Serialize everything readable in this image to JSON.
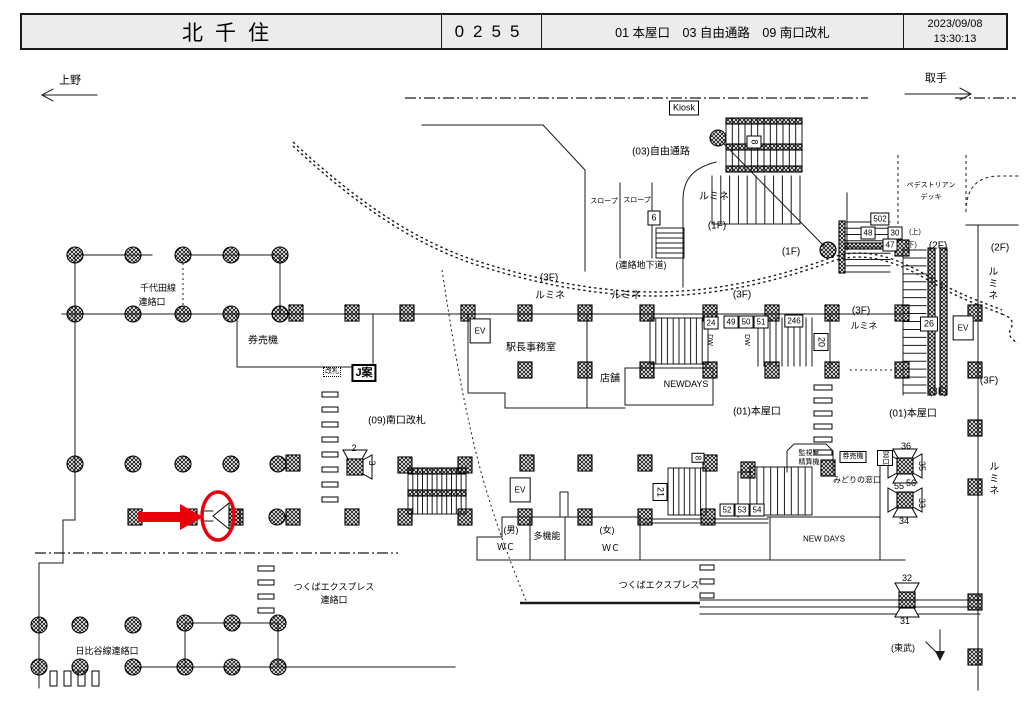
{
  "header": {
    "station": "北千住",
    "code": "0255",
    "sections": "01 本屋口　03 自由通路　09 南口改札",
    "date": "2023/09/08",
    "time": "13:30:13"
  },
  "directions": {
    "left": "上野",
    "right": "取手"
  },
  "colors": {
    "highlight": "#e8000b",
    "ink": "#1a1a1a",
    "header_bg": "#ececec"
  },
  "map_labels": [
    {
      "t": "上野",
      "x": 70,
      "y": 81,
      "c": "f11",
      "n": "direction-ueno"
    },
    {
      "t": "取手",
      "x": 936,
      "y": 79,
      "c": "f11",
      "n": "direction-toride"
    },
    {
      "t": "Kiosk",
      "x": 684,
      "y": 108,
      "c": "bx",
      "n": "kiosk-label"
    },
    {
      "t": "(03)自由通路",
      "x": 661,
      "y": 152,
      "c": "",
      "n": "area-03-jiyutsuro"
    },
    {
      "t": "スロープ",
      "x": 604,
      "y": 202,
      "c": "t",
      "n": "slope-label"
    },
    {
      "t": "スロープ",
      "x": 637,
      "y": 201,
      "c": "t",
      "n": "slope-label"
    },
    {
      "t": "6",
      "x": 654,
      "y": 218,
      "c": "bx",
      "n": "sign-6"
    },
    {
      "t": "ルミネ",
      "x": 714,
      "y": 197,
      "c": "",
      "n": "lumine-label"
    },
    {
      "t": "(1F)",
      "x": 717,
      "y": 226,
      "c": "",
      "n": "floor-1f"
    },
    {
      "t": "(連絡地下道)",
      "x": 641,
      "y": 265,
      "c": "s",
      "n": "underpass-label"
    },
    {
      "t": "8",
      "x": 754,
      "y": 142,
      "c": "bx rot",
      "n": "sign-8"
    },
    {
      "t": "ペデストリアン",
      "x": 931,
      "y": 186,
      "c": "t",
      "n": "pedestrian-deck-label"
    },
    {
      "t": "デッキ",
      "x": 931,
      "y": 198,
      "c": "t",
      "n": "pedestrian-deck-label"
    },
    {
      "t": "(1F)",
      "x": 791,
      "y": 252,
      "c": "",
      "n": "floor-1f"
    },
    {
      "t": "(2F)",
      "x": 938,
      "y": 246,
      "c": "",
      "n": "floor-2f"
    },
    {
      "t": "(2F)",
      "x": 1000,
      "y": 248,
      "c": "",
      "n": "floor-2f"
    },
    {
      "t": "502",
      "x": 880,
      "y": 219,
      "c": "bxs",
      "n": "sign-502"
    },
    {
      "t": "48",
      "x": 868,
      "y": 233,
      "c": "bxs",
      "n": "sign-48"
    },
    {
      "t": "30",
      "x": 895,
      "y": 233,
      "c": "bxs",
      "n": "sign-30"
    },
    {
      "t": "(上)",
      "x": 915,
      "y": 233,
      "c": "t",
      "n": "up-label"
    },
    {
      "t": "47",
      "x": 890,
      "y": 245,
      "c": "bxs",
      "n": "sign-47"
    },
    {
      "t": "(下)",
      "x": 911,
      "y": 246,
      "c": "t",
      "n": "down-label"
    },
    {
      "t": "(3F)",
      "x": 549,
      "y": 278,
      "c": "",
      "n": "floor-3f"
    },
    {
      "t": "ルミネ",
      "x": 550,
      "y": 296,
      "c": "",
      "n": "lumine-label"
    },
    {
      "t": "ルミネ",
      "x": 626,
      "y": 296,
      "c": "",
      "n": "lumine-label"
    },
    {
      "t": "(3F)",
      "x": 742,
      "y": 295,
      "c": "",
      "n": "floor-3f"
    },
    {
      "t": "(3F)",
      "x": 861,
      "y": 311,
      "c": "",
      "n": "floor-3f"
    },
    {
      "t": "ルミネ",
      "x": 864,
      "y": 326,
      "c": "s",
      "n": "lumine-label"
    },
    {
      "t": "千代田線",
      "x": 158,
      "y": 288,
      "c": "s",
      "n": "chiyoda-line-label"
    },
    {
      "t": "連絡口",
      "x": 152,
      "y": 302,
      "c": "s",
      "n": "chiyoda-line-label"
    },
    {
      "t": "券売機",
      "x": 263,
      "y": 341,
      "c": "",
      "n": "ticket-machines-label"
    },
    {
      "t": "改札",
      "x": 332,
      "y": 372,
      "c": "db",
      "n": "kaisatsu-label"
    },
    {
      "t": "J案",
      "x": 364,
      "y": 373,
      "c": "bxb",
      "n": "j-an-label"
    },
    {
      "t": "EV",
      "x": 480,
      "y": 331,
      "c": "bxev",
      "n": "elevator-label"
    },
    {
      "t": "駅長事務室",
      "x": 531,
      "y": 348,
      "c": "",
      "n": "stationmaster-office-label"
    },
    {
      "t": "店舗",
      "x": 610,
      "y": 379,
      "c": "",
      "n": "shop-label"
    },
    {
      "t": "NEWDAYS",
      "x": 686,
      "y": 384,
      "c": "s",
      "n": "newdays-label"
    },
    {
      "t": "24",
      "x": 711,
      "y": 323,
      "c": "bxs",
      "n": "sign-24"
    },
    {
      "t": "49",
      "x": 731,
      "y": 322,
      "c": "bxs",
      "n": "sign-49"
    },
    {
      "t": "50",
      "x": 746,
      "y": 322,
      "c": "bxs",
      "n": "sign-50"
    },
    {
      "t": "51",
      "x": 761,
      "y": 322,
      "c": "bxs",
      "n": "sign-51"
    },
    {
      "t": "246",
      "x": 794,
      "y": 321,
      "c": "bxs",
      "n": "sign-246"
    },
    {
      "t": "DW",
      "x": 709,
      "y": 340,
      "c": "t rot",
      "n": "dw-label"
    },
    {
      "t": "DW",
      "x": 746,
      "y": 340,
      "c": "t rot",
      "n": "dw-label"
    },
    {
      "t": "20",
      "x": 821,
      "y": 342,
      "c": "bx rot",
      "n": "sign-20"
    },
    {
      "t": "26",
      "x": 929,
      "y": 324,
      "c": "bx",
      "n": "sign-26"
    },
    {
      "t": "EV",
      "x": 963,
      "y": 328,
      "c": "bxev",
      "n": "elevator-label"
    },
    {
      "t": "(3F)",
      "x": 938,
      "y": 392,
      "c": "",
      "n": "floor-3f"
    },
    {
      "t": "(3F)",
      "x": 989,
      "y": 381,
      "c": "",
      "n": "floor-3f"
    },
    {
      "t": "ルミネ",
      "x": 991,
      "y": 284,
      "c": "vt",
      "n": "lumine-label"
    },
    {
      "t": "ルミネ",
      "x": 992,
      "y": 479,
      "c": "vt",
      "n": "lumine-label"
    },
    {
      "t": "(09)南口改札",
      "x": 397,
      "y": 421,
      "c": "",
      "n": "area-09-south-gate"
    },
    {
      "t": "2",
      "x": 354,
      "y": 448,
      "c": "s",
      "n": "sign-2"
    },
    {
      "t": "3",
      "x": 372,
      "y": 463,
      "c": "s rot",
      "n": "sign-3"
    },
    {
      "t": "(01)本屋口",
      "x": 757,
      "y": 412,
      "c": "",
      "n": "area-01-honya"
    },
    {
      "t": "(01)本屋口",
      "x": 913,
      "y": 414,
      "c": "",
      "n": "area-01-honya"
    },
    {
      "t": "EV",
      "x": 520,
      "y": 490,
      "c": "bxev",
      "n": "elevator-label"
    },
    {
      "t": "(男)",
      "x": 511,
      "y": 530,
      "c": "s",
      "n": "mens-wc-label"
    },
    {
      "t": "ＷＣ",
      "x": 506,
      "y": 547,
      "c": "s",
      "n": "mens-wc-label"
    },
    {
      "t": "多機能",
      "x": 547,
      "y": 536,
      "c": "s",
      "n": "multifunction-wc-label"
    },
    {
      "t": "(女)",
      "x": 607,
      "y": 530,
      "c": "s",
      "n": "womens-wc-label"
    },
    {
      "t": "ＷＣ",
      "x": 611,
      "y": 548,
      "c": "s",
      "n": "womens-wc-label"
    },
    {
      "t": "21",
      "x": 660,
      "y": 492,
      "c": "bx rot",
      "n": "sign-21"
    },
    {
      "t": "8",
      "x": 698,
      "y": 458,
      "c": "bxs rot",
      "n": "sign-8b"
    },
    {
      "t": "52",
      "x": 727,
      "y": 510,
      "c": "bxs",
      "n": "sign-52"
    },
    {
      "t": "53",
      "x": 742,
      "y": 510,
      "c": "bxs",
      "n": "sign-53"
    },
    {
      "t": "54",
      "x": 757,
      "y": 510,
      "c": "bxs",
      "n": "sign-54"
    },
    {
      "t": "監視室",
      "x": 809,
      "y": 454,
      "c": "t",
      "n": "monitor-room-label"
    },
    {
      "t": "精算機",
      "x": 809,
      "y": 463,
      "c": "t",
      "n": "fare-adjust-label"
    },
    {
      "t": "券売機",
      "x": 853,
      "y": 457,
      "c": "bxt",
      "n": "ticket-machine-box"
    },
    {
      "t": "窓口",
      "x": 885,
      "y": 458,
      "c": "bxt vt2",
      "n": "window-box"
    },
    {
      "t": "みどりの窓口",
      "x": 857,
      "y": 480,
      "c": "f8",
      "n": "midori-no-madoguchi-label"
    },
    {
      "t": "36",
      "x": 906,
      "y": 446,
      "c": "s",
      "n": "sign-36"
    },
    {
      "t": "35",
      "x": 922,
      "y": 466,
      "c": "s rot",
      "n": "sign-35"
    },
    {
      "t": "55",
      "x": 899,
      "y": 486,
      "c": "s",
      "n": "sign-55"
    },
    {
      "t": "56",
      "x": 911,
      "y": 483,
      "c": "s",
      "n": "sign-56"
    },
    {
      "t": "33",
      "x": 922,
      "y": 503,
      "c": "s rot",
      "n": "sign-33"
    },
    {
      "t": "34",
      "x": 904,
      "y": 521,
      "c": "s",
      "n": "sign-34"
    },
    {
      "t": "NEW DAYS",
      "x": 824,
      "y": 539,
      "c": "f8",
      "n": "newdays-label"
    },
    {
      "t": "つくばエクスプレス",
      "x": 659,
      "y": 585,
      "c": "s",
      "n": "tsukuba-express-label"
    },
    {
      "t": "つくばエクスプレス",
      "x": 334,
      "y": 587,
      "c": "s",
      "n": "tsukuba-express-renrakuguchi"
    },
    {
      "t": "連絡口",
      "x": 334,
      "y": 600,
      "c": "s",
      "n": "tsukuba-express-renrakuguchi"
    },
    {
      "t": "日比谷線連絡口",
      "x": 107,
      "y": 651,
      "c": "s",
      "n": "hibiya-line-label"
    },
    {
      "t": "32",
      "x": 907,
      "y": 578,
      "c": "s",
      "n": "sign-32"
    },
    {
      "t": "31",
      "x": 905,
      "y": 621,
      "c": "s",
      "n": "sign-31"
    },
    {
      "t": "(東武)",
      "x": 903,
      "y": 648,
      "c": "s",
      "n": "tobu-label"
    }
  ]
}
